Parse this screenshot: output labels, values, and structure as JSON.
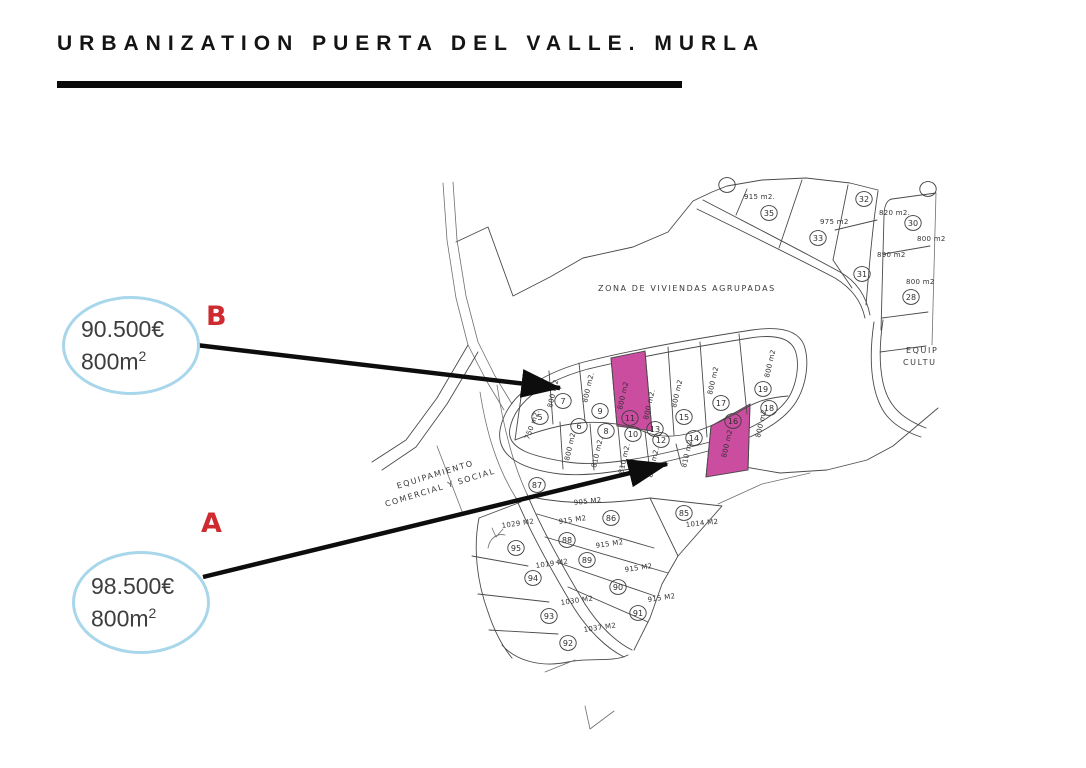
{
  "title": "URBANIZATION PUERTA DEL VALLE. MURLA",
  "callouts": [
    {
      "letter": "B",
      "price": "90.500€",
      "area": "800m",
      "area_sup": "2",
      "points_to_plot": "11"
    },
    {
      "letter": "A",
      "price": "98.500€",
      "area": "800m",
      "area_sup": "2",
      "points_to_plot": "16"
    }
  ],
  "colors": {
    "highlight": "#cb4da0",
    "callout_border": "#a8d6ea",
    "letter": "#ce2b31",
    "arrow": "#0d0d0d",
    "map_line": "#4a4a4a"
  },
  "map": {
    "region_labels": [
      {
        "text": "ZONA DE VIVIENDAS AGRUPADAS",
        "x": 598,
        "y": 291,
        "rot": 0,
        "anchor": "start"
      },
      {
        "text": "EQUIPAMIENTO",
        "x": 436,
        "y": 477,
        "rot": -17,
        "anchor": "middle"
      },
      {
        "text": "COMERCIAL Y SOCIAL",
        "x": 441,
        "y": 490,
        "rot": -17,
        "anchor": "middle"
      },
      {
        "text": "EQUIP",
        "x": 906,
        "y": 353,
        "rot": 0,
        "anchor": "start"
      },
      {
        "text": "CULTU",
        "x": 903,
        "y": 365,
        "rot": 0,
        "anchor": "start"
      }
    ],
    "plots": [
      {
        "num": "35",
        "cx": 769,
        "cy": 213,
        "area": "915 m2.",
        "ax": 744,
        "ay": 199,
        "rot": 0
      },
      {
        "num": "33",
        "cx": 818,
        "cy": 238,
        "area": "975 m2",
        "ax": 820,
        "ay": 224,
        "rot": 0
      },
      {
        "num": "32",
        "cx": 864,
        "cy": 199,
        "area": "820 m2.",
        "ax": 879,
        "ay": 215,
        "rot": 0
      },
      {
        "num": "31",
        "cx": 862,
        "cy": 274,
        "area": "890 m2",
        "ax": 877,
        "ay": 257,
        "rot": 0
      },
      {
        "num": "30",
        "cx": 913,
        "cy": 223,
        "area": "800 m2",
        "ax": 917,
        "ay": 241,
        "rot": 0
      },
      {
        "num": "28",
        "cx": 911,
        "cy": 297,
        "area": "800 m2",
        "ax": 906,
        "ay": 284,
        "rot": 0
      },
      {
        "num": "",
        "cx": 727,
        "cy": 185
      },
      {
        "num": "",
        "cx": 928,
        "cy": 189
      },
      {
        "num": "5",
        "cx": 540,
        "cy": 417,
        "area": "750 m2.",
        "ax": 529,
        "ay": 440,
        "rot": -70
      },
      {
        "num": "7",
        "cx": 563,
        "cy": 401,
        "area": "800 m2",
        "ax": 552,
        "ay": 408,
        "rot": -77
      },
      {
        "num": "9",
        "cx": 600,
        "cy": 411,
        "area": "800 m2.",
        "ax": 587,
        "ay": 403,
        "rot": -77
      },
      {
        "num": "11",
        "cx": 630,
        "cy": 418,
        "area": "800 m2",
        "ax": 622,
        "ay": 410,
        "rot": -77,
        "hl": true
      },
      {
        "num": "13",
        "cx": 655,
        "cy": 429,
        "area": "800 m2.",
        "ax": 648,
        "ay": 420,
        "rot": -77
      },
      {
        "num": "15",
        "cx": 684,
        "cy": 417,
        "area": "800 m2",
        "ax": 676,
        "ay": 408,
        "rot": -77
      },
      {
        "num": "17",
        "cx": 721,
        "cy": 403,
        "area": "800 m2",
        "ax": 712,
        "ay": 395,
        "rot": -77
      },
      {
        "num": "19",
        "cx": 763,
        "cy": 389,
        "area": "800 m2",
        "ax": 769,
        "ay": 378,
        "rot": -77
      },
      {
        "num": "6",
        "cx": 579,
        "cy": 426,
        "area": "800 m2",
        "ax": 569,
        "ay": 461,
        "rot": -77
      },
      {
        "num": "8",
        "cx": 606,
        "cy": 431,
        "area": "810 m2.",
        "ax": 596,
        "ay": 468,
        "rot": -77
      },
      {
        "num": "10",
        "cx": 633,
        "cy": 434,
        "area": "810 m2.",
        "ax": 623,
        "ay": 474,
        "rot": -77
      },
      {
        "num": "12",
        "cx": 661,
        "cy": 440,
        "area": "810 m2.",
        "ax": 652,
        "ay": 478,
        "rot": -77
      },
      {
        "num": "14",
        "cx": 694,
        "cy": 438,
        "area": "810 m2",
        "ax": 686,
        "ay": 468,
        "rot": -77
      },
      {
        "num": "16",
        "cx": 733,
        "cy": 421,
        "area": "800 m2",
        "ax": 726,
        "ay": 458,
        "rot": -77,
        "hl": true
      },
      {
        "num": "18",
        "cx": 769,
        "cy": 408,
        "area": "800 m2.",
        "ax": 760,
        "ay": 438,
        "rot": -77
      },
      {
        "num": "87",
        "cx": 537,
        "cy": 485
      },
      {
        "num": "86",
        "cx": 611,
        "cy": 518,
        "area": "905 M2",
        "ax": 574,
        "ay": 505,
        "rot": -6
      },
      {
        "num": "88",
        "cx": 567,
        "cy": 540,
        "area": "915 M2",
        "ax": 559,
        "ay": 524,
        "rot": -8
      },
      {
        "num": "89",
        "cx": 587,
        "cy": 560,
        "area": "915 M2",
        "ax": 596,
        "ay": 548,
        "rot": -8
      },
      {
        "num": "90",
        "cx": 618,
        "cy": 587,
        "area": "915 M2",
        "ax": 625,
        "ay": 572,
        "rot": -8
      },
      {
        "num": "91",
        "cx": 638,
        "cy": 613,
        "area": "915 M2",
        "ax": 648,
        "ay": 602,
        "rot": -8
      },
      {
        "num": "85",
        "cx": 684,
        "cy": 513,
        "area": "1014 M2",
        "ax": 686,
        "ay": 527,
        "rot": -6
      },
      {
        "num": "95",
        "cx": 516,
        "cy": 548,
        "area": "1029 M2",
        "ax": 502,
        "ay": 528,
        "rot": -8
      },
      {
        "num": "94",
        "cx": 533,
        "cy": 578,
        "area": "1019 M2",
        "ax": 536,
        "ay": 568,
        "rot": -8
      },
      {
        "num": "93",
        "cx": 549,
        "cy": 616,
        "area": "1030 M2",
        "ax": 561,
        "ay": 605,
        "rot": -8
      },
      {
        "num": "92",
        "cx": 568,
        "cy": 643,
        "area": "1037 M2",
        "ax": 584,
        "ay": 632,
        "rot": -8
      }
    ]
  }
}
